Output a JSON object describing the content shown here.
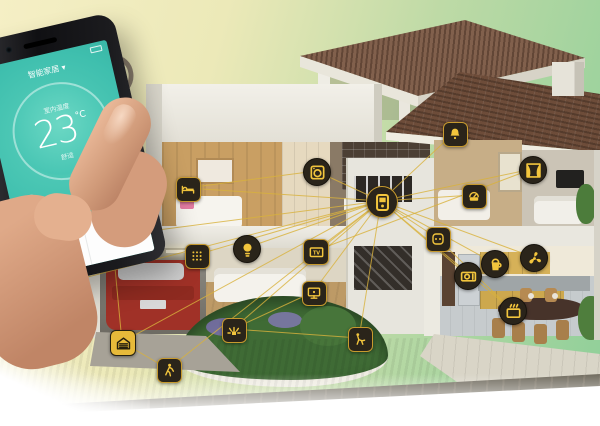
{
  "scene": {
    "description": "smart-home cutaway house with connected device icons and hand holding phone",
    "background_left": "#f5efc5",
    "background_right": "#8fcf99"
  },
  "colors": {
    "accent_yellow": "#f0c23a",
    "line_yellow": "#d9b23c",
    "icon_bg": "#2a241a",
    "screen_teal": "#3fbfae",
    "shield_green": "#3cb54a",
    "roof_brown": "#6d4c39",
    "lawn_green": "#6a9a4e",
    "car_red": "#a03127"
  },
  "phone": {
    "app_title": "智能家居 ▾",
    "temp_top_label": "室内温度",
    "temp_value": "23",
    "temp_unit": "°C",
    "temp_bottom_label": "舒适",
    "security_row": "安防模式 · 已设防",
    "action_left": "日程",
    "action_right": "编辑"
  },
  "devices": {
    "hub_id": "control-hub",
    "icons": [
      {
        "id": "bedroom-bed",
        "glyph": "bed",
        "shape": "square",
        "x": 187,
        "y": 188
      },
      {
        "id": "washing-machine",
        "glyph": "washer",
        "shape": "circle",
        "x": 316,
        "y": 171
      },
      {
        "id": "alarm-bell",
        "glyph": "bell",
        "shape": "square",
        "x": 454,
        "y": 133
      },
      {
        "id": "smart-curtains",
        "glyph": "curtain",
        "shape": "circle",
        "x": 532,
        "y": 169
      },
      {
        "id": "energy-meter",
        "glyph": "meter",
        "shape": "square",
        "x": 473,
        "y": 195
      },
      {
        "id": "control-hub",
        "glyph": "hub",
        "shape": "circle",
        "x": 381,
        "y": 201,
        "size": 30,
        "hub": true
      },
      {
        "id": "smart-socket",
        "glyph": "socket",
        "shape": "square",
        "x": 437,
        "y": 238
      },
      {
        "id": "security-camera",
        "glyph": "camera",
        "shape": "circle",
        "x": 112,
        "y": 236,
        "size": 22
      },
      {
        "id": "charging-plug",
        "glyph": "plug",
        "shape": "square",
        "x": 49,
        "y": 287
      },
      {
        "id": "garage-door",
        "glyph": "garage",
        "shape": "square",
        "x": 122,
        "y": 342,
        "size": 24,
        "variant": "yellow"
      },
      {
        "id": "motion-sensor",
        "glyph": "person",
        "shape": "square",
        "x": 168,
        "y": 369
      },
      {
        "id": "wall-keypad",
        "glyph": "keypad",
        "shape": "square",
        "x": 196,
        "y": 255
      },
      {
        "id": "ceiling-light",
        "glyph": "bulb",
        "shape": "circle",
        "x": 246,
        "y": 248
      },
      {
        "id": "smart-tv",
        "glyph": "tv",
        "shape": "square",
        "x": 315,
        "y": 251,
        "size": 24
      },
      {
        "id": "media-screen",
        "glyph": "screen",
        "shape": "square",
        "x": 313,
        "y": 292
      },
      {
        "id": "garden-sprinkler",
        "glyph": "sprinkler",
        "shape": "square",
        "x": 233,
        "y": 329
      },
      {
        "id": "lawn-mower",
        "glyph": "mower",
        "shape": "square",
        "x": 359,
        "y": 338
      },
      {
        "id": "microwave-oven",
        "glyph": "microwave",
        "shape": "circle",
        "x": 467,
        "y": 275
      },
      {
        "id": "smart-kettle",
        "glyph": "kettle",
        "shape": "circle",
        "x": 494,
        "y": 263
      },
      {
        "id": "ventilation-fan",
        "glyph": "fan",
        "shape": "circle",
        "x": 533,
        "y": 257
      },
      {
        "id": "smart-oven",
        "glyph": "oven",
        "shape": "circle",
        "x": 512,
        "y": 310
      }
    ],
    "extra_links": [
      [
        "security-camera",
        "charging-plug"
      ],
      [
        "security-camera",
        "garage-door"
      ],
      [
        "garage-door",
        "motion-sensor"
      ],
      [
        "garden-sprinkler",
        "lawn-mower"
      ],
      [
        "smart-tv",
        "smart-curtains"
      ],
      [
        "washing-machine",
        "bedroom-bed"
      ],
      [
        "smart-socket",
        "smart-oven"
      ],
      [
        "media-screen",
        "garden-sprinkler"
      ]
    ]
  }
}
